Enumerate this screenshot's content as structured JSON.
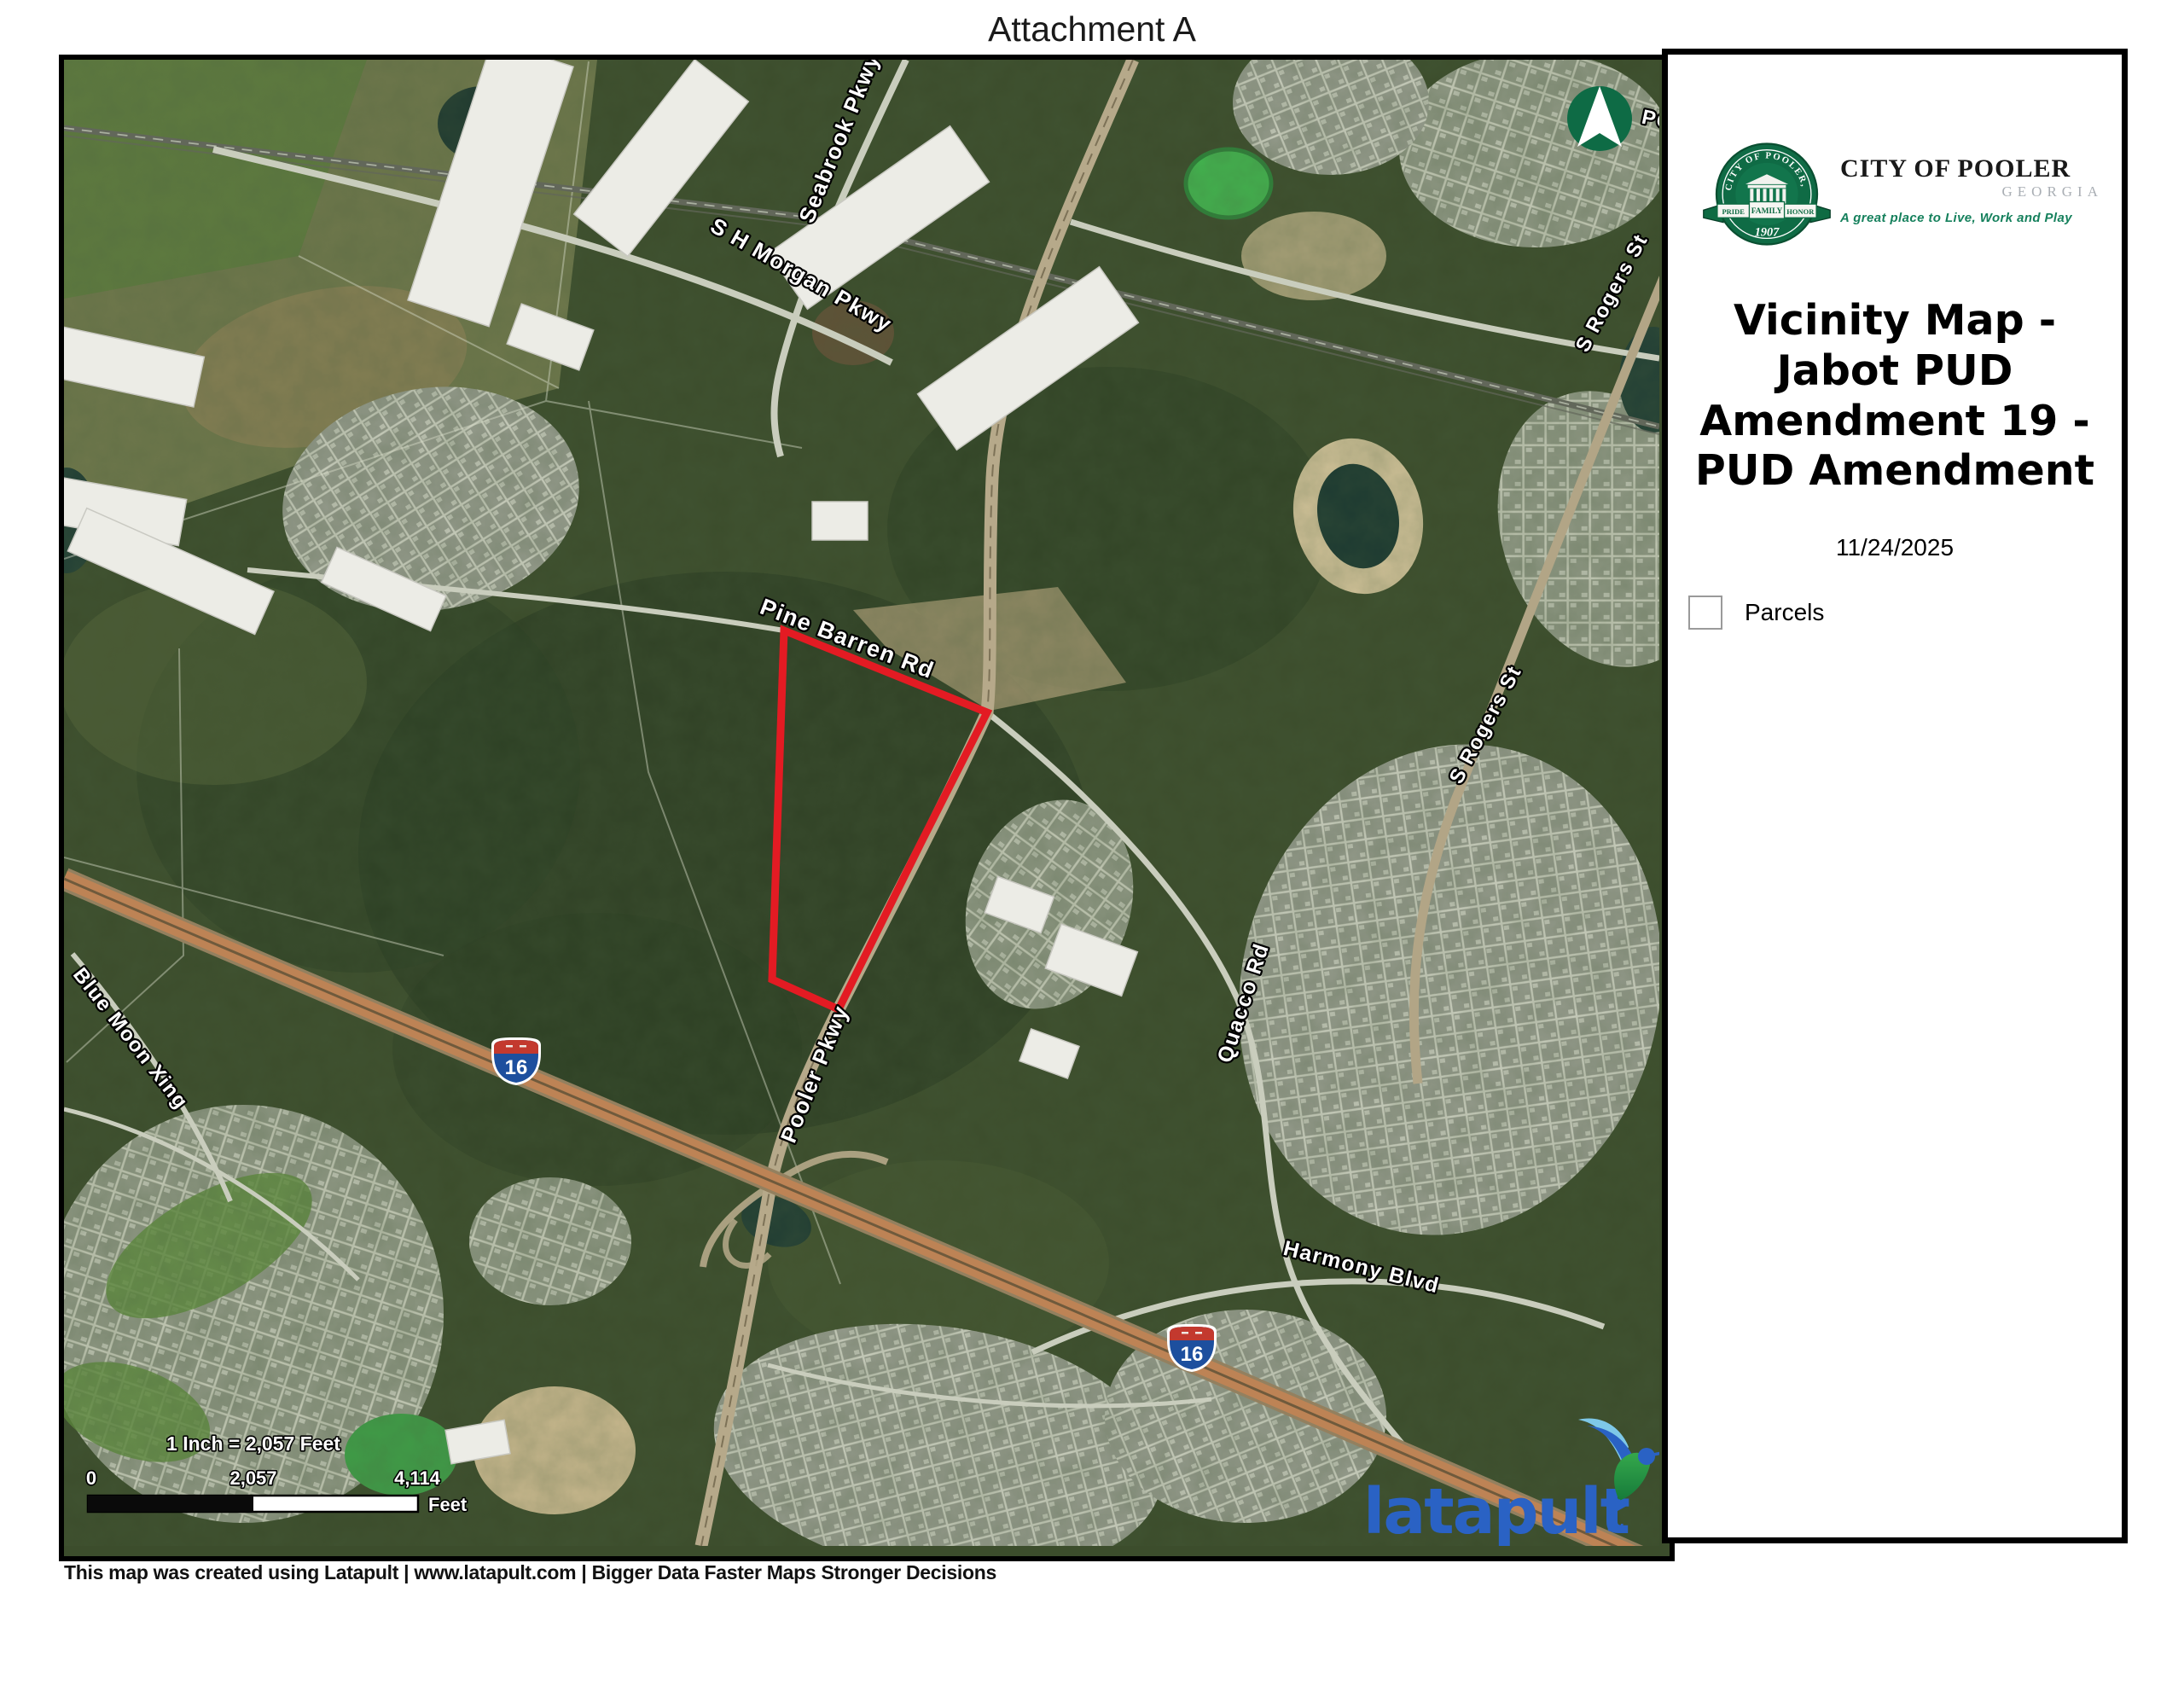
{
  "page": {
    "header": "Attachment A",
    "footer": "This map was created using Latapult | www.latapult.com | Bigger Data Faster Maps Stronger Decisions"
  },
  "panel": {
    "seal": {
      "ring_text": "CITY OF POOLER, GA",
      "ribbon": [
        "PRIDE",
        "FAMILY",
        "HONOR"
      ],
      "year": "1907"
    },
    "org": {
      "name": "CITY OF POOLER",
      "state": "GEORGIA",
      "tagline": "A great place to Live, Work and Play"
    },
    "title": "Vicinity Map - Jabot PUD Amendment 19 - PUD Amendment",
    "date": "11/24/2025",
    "legend": {
      "parcels_label": "Parcels"
    }
  },
  "map": {
    "road_labels": {
      "seabrook": "Seabrook Pkwy",
      "sh_morgan": "S H Morgan Pkwy",
      "pine_barren": "Pine Barren Rd",
      "pooler_pkwy": "Pooler Pkwy",
      "blue_moon": "Blue Moon Xing",
      "quacco": "Quacco Rd",
      "harmony": "Harmony Blvd",
      "s_rogers_north": "S Rogers St",
      "s_rogers_south": "S Rogers St",
      "edge_partial": "PC"
    },
    "interstate": {
      "shields": [
        "16",
        "16"
      ]
    },
    "scale": {
      "ratio_text": "1 Inch = 2,057 Feet",
      "tick_0": "0",
      "tick_mid": "2,057",
      "tick_max": "4,114",
      "unit": "Feet"
    },
    "watermark": {
      "text": "latapult",
      "mark": "SM"
    }
  },
  "colors": {
    "parcel_outline": "#e31b23",
    "north_arrow_green": "#0e6b45",
    "tagline_green": "#15805c",
    "latapult_blue": "#2a62c4",
    "interstate_blue": "#1d4f9e",
    "interstate_red": "#c3392e",
    "highway_tan": "#bd8355"
  }
}
